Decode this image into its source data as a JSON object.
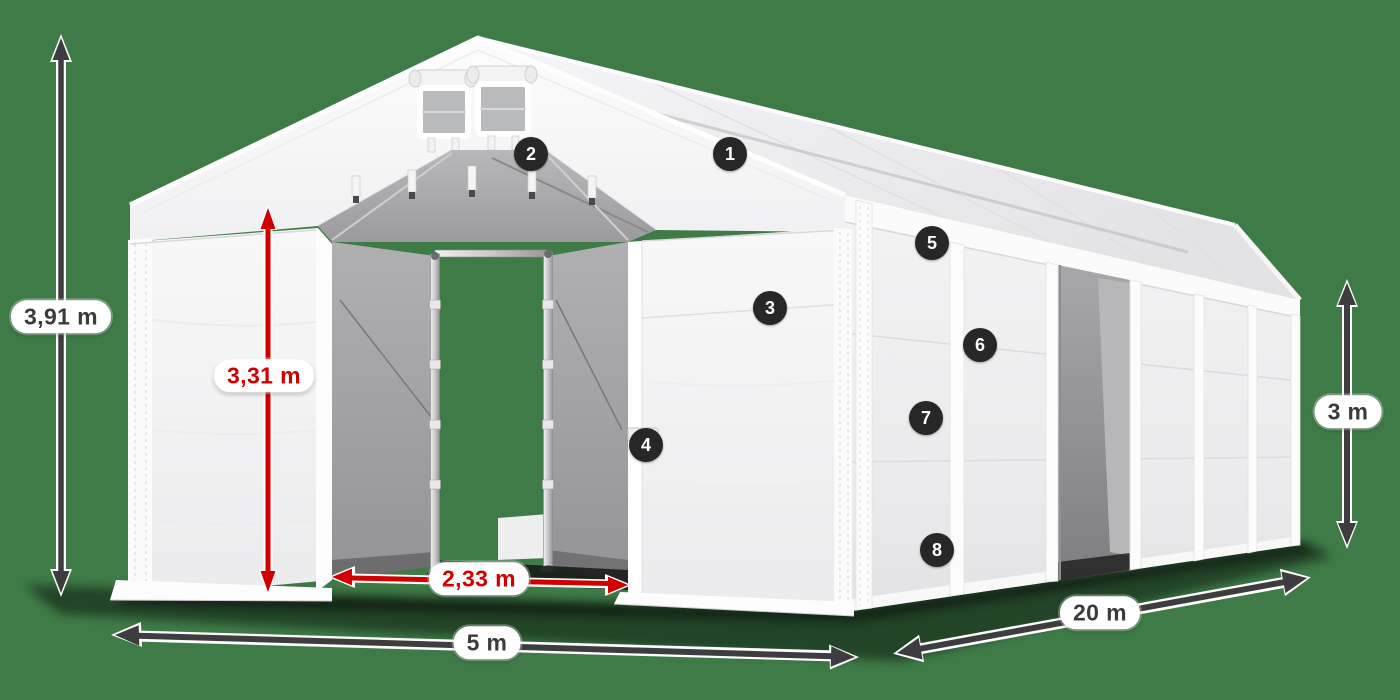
{
  "diagram": {
    "name": "storage-tent-dimension-diagram",
    "dimensions": {
      "total_height": "3,91 m",
      "entrance_height": "3,31 m",
      "entrance_width": "2,33 m",
      "width": "5 m",
      "length": "20 m",
      "side_height": "3 m"
    },
    "callouts": [
      "1",
      "2",
      "3",
      "4",
      "5",
      "6",
      "7",
      "8"
    ],
    "colors": {
      "background": "#3e7b47",
      "dimension_gray": "#3d3d3f",
      "dimension_red": "#d10000",
      "label_background": "#ffffff",
      "label_text_dark": "#3b3b3d",
      "badge_background": "#272727",
      "badge_text": "#ffffff",
      "tent_white": "#f7f7f8",
      "interior_gray": "#a6a6a8"
    }
  }
}
